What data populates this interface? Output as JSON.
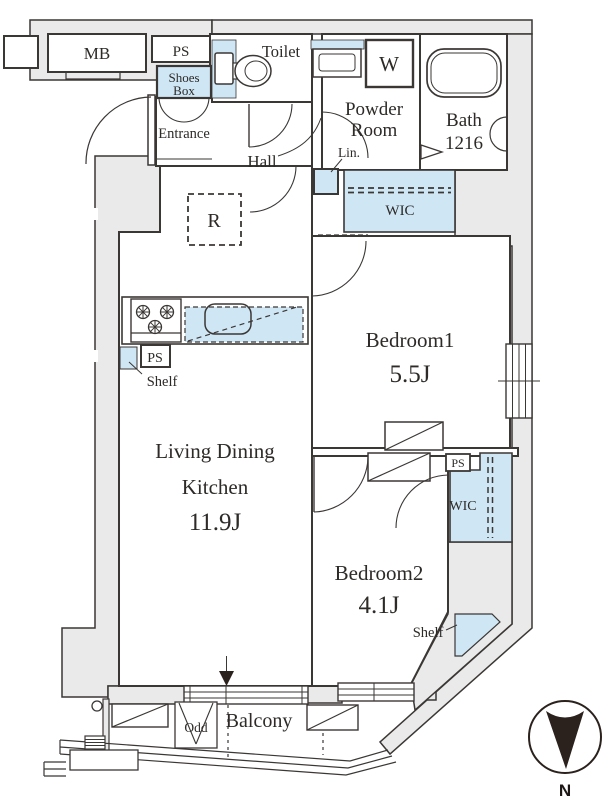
{
  "labels": {
    "mb": "MB",
    "ps_meter": "PS",
    "toilet": "Toilet",
    "shoes_line1": "Shoes",
    "shoes_line2": "Box",
    "entrance": "Entrance",
    "hall": "Hall",
    "powder_line1": "Powder",
    "powder_line2": "Room",
    "washer": "W",
    "bath_line1": "Bath",
    "bath_line2": "1216",
    "linen": "Lin.",
    "wic_hall": "WIC",
    "refrigerator": "R",
    "bedroom1_name": "Bedroom1",
    "bedroom1_size": "5.5J",
    "shelf_kitchen": "Shelf",
    "ps_kitchen": "PS",
    "ldk_line1": "Living Dining",
    "ldk_line2": "Kitchen",
    "ldk_size": "11.9J",
    "ps_bedroom": "PS",
    "wic_bedroom2": "WIC",
    "bedroom2_name": "Bedroom2",
    "bedroom2_size": "4.1J",
    "shelf_bedroom2": "Shelf",
    "odd": "Odd",
    "balcony": "Balcony",
    "compass_north": "N"
  },
  "colors": {
    "closet_blue": "#cfe6f5",
    "wall_gray": "#eaeaea",
    "line": "#3b3735",
    "compass_needle": "#2b211d"
  }
}
